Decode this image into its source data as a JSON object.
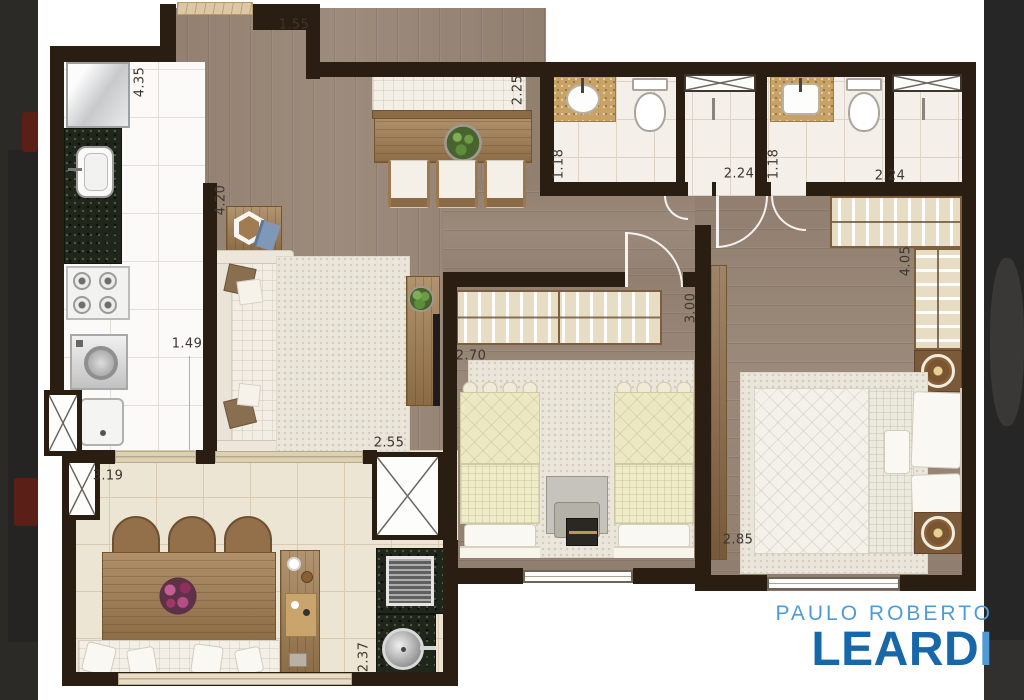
{
  "canvas": {
    "width": 1024,
    "height": 700,
    "background": "#ffffff"
  },
  "side_bands": {
    "left": {
      "color": "#2b2a27",
      "accent_color": "#5a1f16"
    },
    "right": {
      "color": "#262626"
    }
  },
  "logo": {
    "line1": "PAULO ROBERTO",
    "line2_main": "LEARD",
    "line2_accent": "I",
    "light_blue": "#4f9bd5",
    "dark_blue": "#1767a9"
  },
  "plan": {
    "wall_color": "#2a1d12",
    "wood_floor_color": "#9c8a7b",
    "kitchen_tile_color": "#fbfaf8",
    "bath_tile_color": "#f4efe9",
    "balcony_tile_color": "#ede5d3",
    "granite_color": "#20261b",
    "dimensions": [
      {
        "value": "1.55",
        "orientation": "horizontal"
      },
      {
        "value": "4.35",
        "orientation": "vertical"
      },
      {
        "value": "2.25",
        "orientation": "vertical"
      },
      {
        "value": "1.18",
        "orientation": "vertical"
      },
      {
        "value": "2.24",
        "orientation": "horizontal"
      },
      {
        "value": "1.18",
        "orientation": "vertical"
      },
      {
        "value": "2.24",
        "orientation": "horizontal"
      },
      {
        "value": "4.20",
        "orientation": "vertical"
      },
      {
        "value": "1.49",
        "orientation": "horizontal"
      },
      {
        "value": "2.70",
        "orientation": "horizontal"
      },
      {
        "value": "3.00",
        "orientation": "vertical"
      },
      {
        "value": "4.05",
        "orientation": "vertical"
      },
      {
        "value": "2.55",
        "orientation": "horizontal"
      },
      {
        "value": "2.85",
        "orizontation": "horizontal",
        "orientation": "horizontal"
      },
      {
        "value": "3.19",
        "orientation": "horizontal"
      },
      {
        "value": "2.37",
        "orientation": "vertical"
      }
    ],
    "furniture_icons": [
      "refrigerator",
      "kitchen-sink",
      "stove",
      "washing-machine",
      "water-heater",
      "sofa",
      "entry-side-table",
      "tv-console",
      "potted-plant",
      "dining-banquette",
      "dining-table",
      "dining-chair",
      "bathroom-sink",
      "toilet",
      "shower-box",
      "wardrobe-hangers",
      "single-bed",
      "study-desk",
      "double-bed",
      "bedside-lamp",
      "rug",
      "balcony-chair",
      "balcony-table",
      "flower-centerpiece",
      "balcony-bench",
      "bar-cabinet",
      "barbecue-grill",
      "round-sink",
      "door-swing",
      "ventilation-shaft",
      "window",
      "entry-doormat"
    ]
  }
}
